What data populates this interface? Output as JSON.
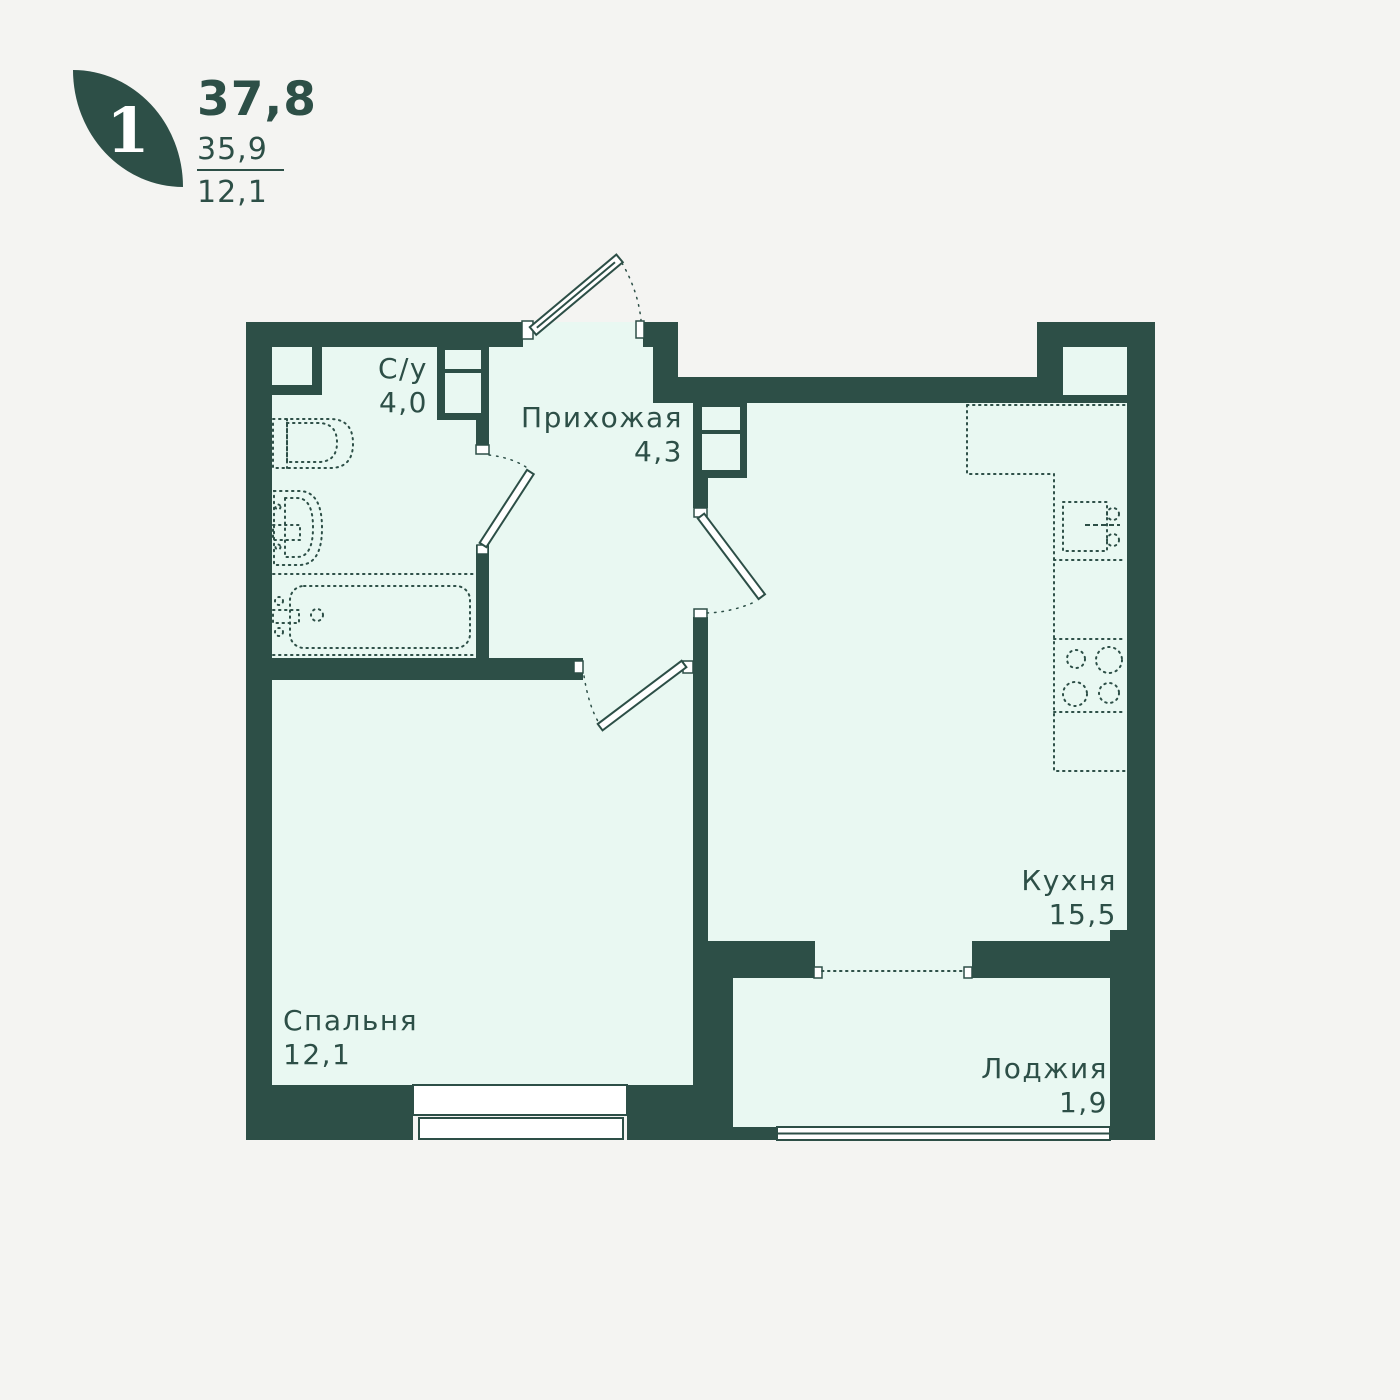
{
  "logo": {
    "room_count": "1",
    "area_total": "37,8",
    "area_no_loggia": "35,9",
    "area_living": "12,1"
  },
  "rooms": {
    "bathroom": {
      "name": "С/у",
      "area": "4,0"
    },
    "hallway": {
      "name": "Прихожая",
      "area": "4,3"
    },
    "kitchen": {
      "name": "Кухня",
      "area": "15,5"
    },
    "bedroom": {
      "name": "Спальня",
      "area": "12,1"
    },
    "loggia": {
      "name": "Лоджия",
      "area": "1,9"
    }
  },
  "colors": {
    "wall": "#2d4f47",
    "room_fill": "#e9f8f2",
    "background": "#f4f4f2",
    "white": "#ffffff"
  }
}
